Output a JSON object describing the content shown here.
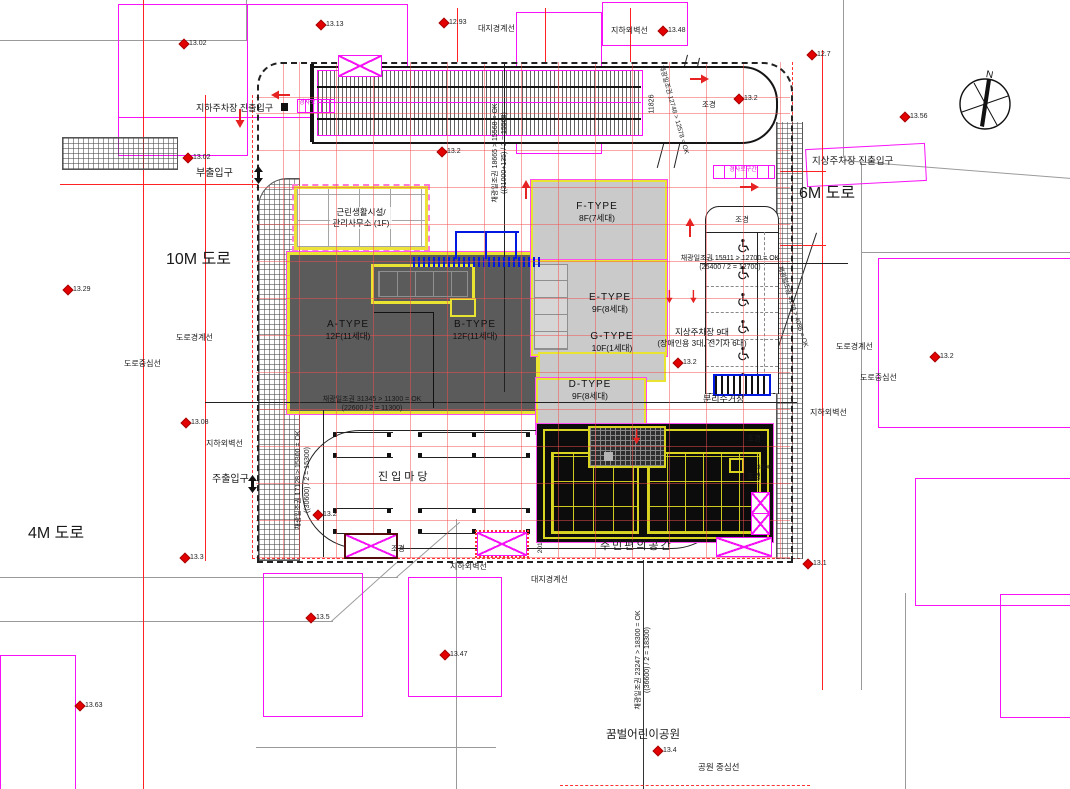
{
  "north": {
    "label": "N"
  },
  "buildings": {
    "neighborhood_facility": {
      "line1": "근린생활시설/",
      "line2": "관리사무소 (1F)"
    },
    "a_type": {
      "name": "A-TYPE",
      "floors": "12F(11세대)"
    },
    "b_type": {
      "name": "B-TYPE",
      "floors": "12F(11세대)"
    },
    "f_type": {
      "name": "F-TYPE",
      "floors": "8F(7세대)"
    },
    "e_type": {
      "name": "E-TYPE",
      "floors": "9F(8세대)"
    },
    "g_type": {
      "name": "G-TYPE",
      "floors": "10F(1세대)"
    },
    "d_type": {
      "name": "D-TYPE",
      "floors": "9F(8세대)"
    }
  },
  "parking": {
    "head_label": "조경",
    "stall_rows": 6,
    "label_line1": "지상주차장 9대",
    "label_line2": "(장애인용 3대, 전기차 6대)"
  },
  "floating_labels": [
    {
      "name": "road-label-10m",
      "text": "10M 도로",
      "x": 166,
      "y": 250,
      "fs": 16
    },
    {
      "name": "road-label-4m",
      "text": "4M 도로",
      "x": 28,
      "y": 524,
      "fs": 16
    },
    {
      "name": "road-label-6m",
      "text": "6M 도로",
      "x": 799,
      "y": 184,
      "fs": 16
    },
    {
      "name": "underground-parking-entrance-label",
      "text": "지하주차장 진출입구",
      "x": 196,
      "y": 103,
      "fs": 9
    },
    {
      "name": "sub-entrance-label",
      "text": "부출입구",
      "x": 196,
      "y": 167,
      "fs": 10
    },
    {
      "name": "main-entrance-label",
      "text": "주출입구",
      "x": 212,
      "y": 473,
      "fs": 10
    },
    {
      "name": "ground-parking-entrance-label",
      "text": "지상주차장 진출입구",
      "x": 812,
      "y": 156,
      "fs": 9.5
    },
    {
      "name": "entry-yard-label",
      "text": "진입마당",
      "x": 378,
      "y": 470,
      "fs": 11,
      "ls": 3
    },
    {
      "name": "community-space-label",
      "text": "주민편의공간",
      "x": 600,
      "y": 539,
      "fs": 11,
      "ls": 2
    },
    {
      "name": "children-park-label",
      "text": "꿈벌어린이공원",
      "x": 606,
      "y": 728,
      "fs": 11.5
    },
    {
      "name": "recycling-station-label",
      "text": "분리수거장",
      "x": 703,
      "y": 394,
      "fs": 9
    },
    {
      "name": "site-boundary-label-top",
      "text": "대지경계선",
      "x": 478,
      "y": 24,
      "fs": 8
    },
    {
      "name": "underground-wall-label-top",
      "text": "지하외벽선",
      "x": 611,
      "y": 26,
      "fs": 8
    },
    {
      "name": "road-edge-label-left",
      "text": "도로경계선",
      "x": 176,
      "y": 333,
      "fs": 8
    },
    {
      "name": "road-center-label-left",
      "text": "도로중심선",
      "x": 124,
      "y": 359,
      "fs": 8
    },
    {
      "name": "road-edge-label-right",
      "text": "도로경계선",
      "x": 836,
      "y": 342,
      "fs": 8
    },
    {
      "name": "road-center-label-right",
      "text": "도로중심선",
      "x": 860,
      "y": 373,
      "fs": 8
    },
    {
      "name": "underground-wall-label-right",
      "text": "지하외벽선",
      "x": 810,
      "y": 408,
      "fs": 8
    },
    {
      "name": "underground-wall-label-left",
      "text": "지하외벽선",
      "x": 206,
      "y": 439,
      "fs": 8
    },
    {
      "name": "underground-wall-label-bottom",
      "text": "지하외벽선",
      "x": 450,
      "y": 562,
      "fs": 8
    },
    {
      "name": "site-boundary-label-bottom",
      "text": "대지경계선",
      "x": 531,
      "y": 575,
      "fs": 8
    },
    {
      "name": "park-centerline-label",
      "text": "공원 중심선",
      "x": 698,
      "y": 762,
      "fs": 8.5
    },
    {
      "name": "landscape-label",
      "text": "조경",
      "x": 702,
      "y": 100,
      "fs": 7.5
    },
    {
      "name": "landscape-label",
      "text": "조경",
      "x": 391,
      "y": 544,
      "fs": 7.5
    },
    {
      "name": "landscape-label",
      "text": "조경",
      "x": 747,
      "y": 434,
      "fs": 7.5
    },
    {
      "name": "landscape-label",
      "text": "조경",
      "x": 747,
      "y": 472,
      "fs": 7.5
    },
    {
      "name": "daylight-note",
      "text": "채광일조권 31345 > 11300 = OK\n(22600 / 2 = 11300)",
      "x": 372,
      "y": 404,
      "fs": 7,
      "c": true
    },
    {
      "name": "daylight-note",
      "text": "채광일조권 15911 > 12700 = OK\n(25400 / 2 = 12700)",
      "x": 730,
      "y": 263,
      "fs": 7,
      "c": true
    },
    {
      "name": "daylight-note",
      "text": "채광일조권 18665 > 15568 = OK\n((31000+135) / 2 = 15568)",
      "x": 500,
      "y": 153,
      "fs": 7,
      "c": true,
      "rot": -90
    },
    {
      "name": "daylight-note",
      "text": "채광일조권 17128 > 15300 = OK\n((30600) / 2 = 15300)",
      "x": 303,
      "y": 480,
      "fs": 7,
      "c": true,
      "rot": -90
    },
    {
      "name": "daylight-note",
      "text": "채광일조권 23247 > 18300 = OK\n((36600) / 2 = 18300)",
      "x": 643,
      "y": 660,
      "fs": 7,
      "c": true,
      "rot": -90
    },
    {
      "name": "daylight-note",
      "text": "채광일조권 12748 > 12578 = OK",
      "x": 673,
      "y": 110,
      "fs": 6.5,
      "c": true,
      "rot": 74
    },
    {
      "name": "daylight-note",
      "text": "채광일조권 4170 > 4085 = OK",
      "x": 792,
      "y": 307,
      "fs": 6.5,
      "c": true,
      "rot": 72
    },
    {
      "name": "dimension-label",
      "text": "11826",
      "x": 652,
      "y": 104,
      "fs": 7,
      "c": true,
      "rot": -90
    },
    {
      "name": "dimension-label",
      "text": "2015",
      "x": 541,
      "y": 546,
      "fs": 6.5,
      "c": true,
      "rot": -90
    },
    {
      "name": "dimension-label",
      "text": "3500",
      "x": 757,
      "y": 464,
      "fs": 6.5
    },
    {
      "name": "ramp-tag",
      "text": "경사로",
      "x": 299,
      "y": 100,
      "fs": 6,
      "color": "#e012e0"
    },
    {
      "name": "ramp-tag",
      "text": "경사로구간",
      "x": 743,
      "y": 171,
      "fs": 6,
      "c": true,
      "color": "#e012e0"
    }
  ],
  "elevation_markers": [
    {
      "v": "13.02",
      "x": 181,
      "y": 40
    },
    {
      "v": "13.13",
      "x": 318,
      "y": 21
    },
    {
      "v": "12.93",
      "x": 441,
      "y": 19
    },
    {
      "v": "13.48",
      "x": 660,
      "y": 27
    },
    {
      "v": "12.7",
      "x": 809,
      "y": 51
    },
    {
      "v": "13.2",
      "x": 736,
      "y": 95
    },
    {
      "v": "13.56",
      "x": 902,
      "y": 113
    },
    {
      "v": "13.2",
      "x": 439,
      "y": 148
    },
    {
      "v": "13.02",
      "x": 185,
      "y": 154
    },
    {
      "v": "13.29",
      "x": 65,
      "y": 286
    },
    {
      "v": "13.2",
      "x": 932,
      "y": 353
    },
    {
      "v": "13.2",
      "x": 675,
      "y": 359
    },
    {
      "v": "13.08",
      "x": 183,
      "y": 419
    },
    {
      "v": "13.2",
      "x": 315,
      "y": 511
    },
    {
      "v": "13.3",
      "x": 182,
      "y": 554
    },
    {
      "v": "13.1",
      "x": 805,
      "y": 560
    },
    {
      "v": "13.5",
      "x": 308,
      "y": 614
    },
    {
      "v": "13.47",
      "x": 442,
      "y": 651
    },
    {
      "v": "13.63",
      "x": 77,
      "y": 702
    },
    {
      "v": "13.4",
      "x": 655,
      "y": 747
    }
  ],
  "colors": {
    "accent_yellow": "#e8e431",
    "magenta": "#f812f8",
    "grid_red": "#f44e4e",
    "dark_building": "#5b5b5b",
    "light_building": "#cacaca",
    "black_building": "#0c0c0c",
    "blue": "#0018e0",
    "marker_red": "#e20000"
  }
}
